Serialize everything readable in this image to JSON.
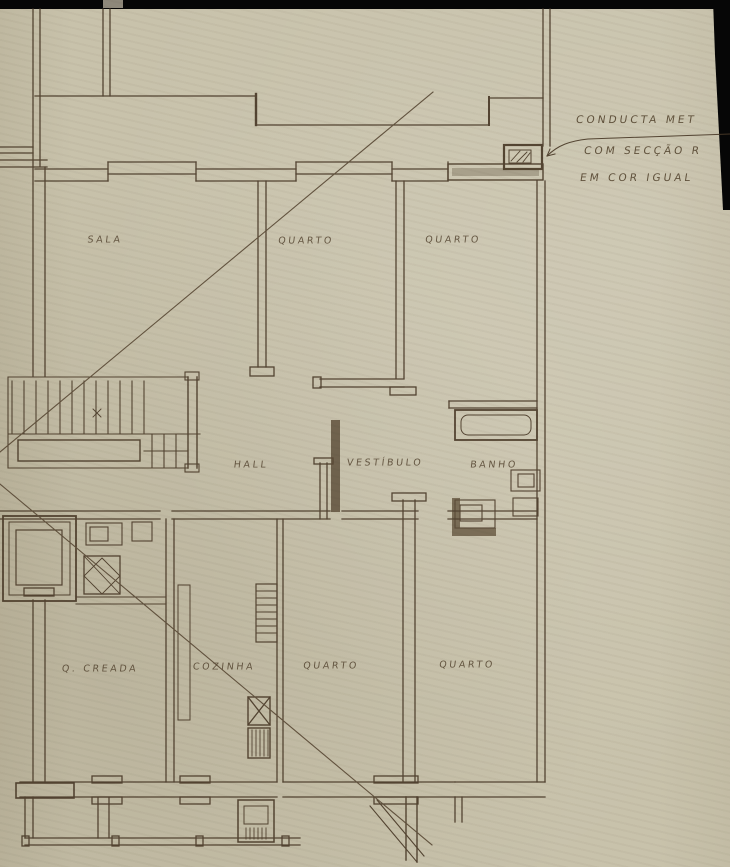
{
  "drawing": {
    "title_context": "architectural floor plan (scanned hand drawing)",
    "rooms": [
      {
        "id": "sala",
        "label": "SALA"
      },
      {
        "id": "quarto-1",
        "label": "QUARTO"
      },
      {
        "id": "quarto-2",
        "label": "QUARTO"
      },
      {
        "id": "hall",
        "label": "HALL"
      },
      {
        "id": "vestibulo",
        "label": "VESTÍBULO"
      },
      {
        "id": "banho",
        "label": "BANHO"
      },
      {
        "id": "q-creada",
        "label": "Q. CREADA"
      },
      {
        "id": "cozinha",
        "label": "COZINHA"
      },
      {
        "id": "quarto-3",
        "label": "QUARTO"
      },
      {
        "id": "quarto-4",
        "label": "QUARTO"
      }
    ],
    "annotations": {
      "line1": "CONDUCTA MET",
      "line2": "COM SECÇÃO R",
      "line3": "EM COR IGUAL"
    },
    "colors": {
      "paper": "#c8c2ab",
      "ink": "#4a3a28",
      "ink_light": "#6b5a44",
      "scan_mask": "#060606"
    }
  }
}
